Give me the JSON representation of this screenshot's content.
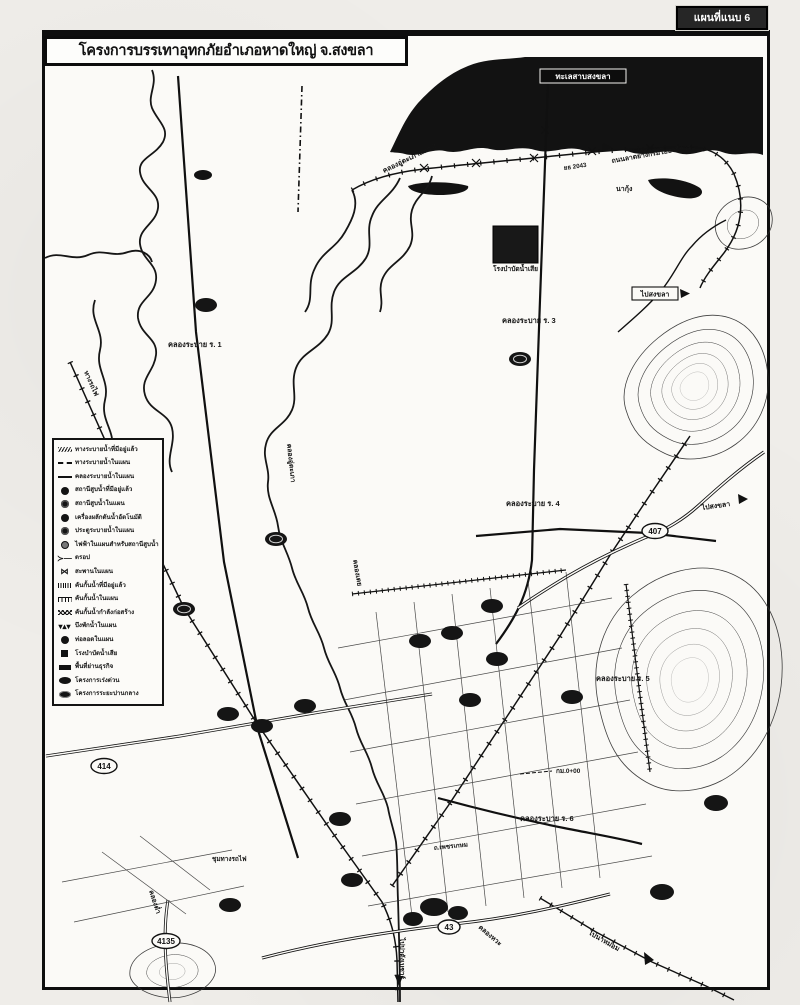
{
  "header": {
    "attachment_tag": "แผนที่แนบ 6",
    "title": "โครงการบรรเทาอุทกภัยอำเภอหาดใหญ่ จ.สงขลา"
  },
  "legend": {
    "items": [
      {
        "icon": "existing-drainage-line-icon",
        "label": "ทางระบายน้ำที่มีอยู่แล้ว"
      },
      {
        "icon": "planned-drainage-line-icon",
        "label": "ทางระบายน้ำในแผน"
      },
      {
        "icon": "planned-canal-line-icon",
        "label": "คลองระบายน้ำในแผน"
      },
      {
        "icon": "existing-pump-station-icon",
        "label": "สถานีสูบน้ำที่มีอยู่แล้ว"
      },
      {
        "icon": "planned-pump-station-icon",
        "label": "สถานีสูบน้ำในแผน"
      },
      {
        "icon": "auto-water-propulsion-icon",
        "label": "เครื่องผลักดันน้ำอัตโนมัติ"
      },
      {
        "icon": "planned-sluice-gate-icon",
        "label": "ประตูระบายน้ำในแผน"
      },
      {
        "icon": "pump-electricity-icon",
        "label": "ไฟฟ้าในแผนสำหรับสถานีสูบน้ำ"
      },
      {
        "icon": "drop-structure-icon",
        "label": "ดรอป"
      },
      {
        "icon": "planned-bridge-icon",
        "label": "สะพานในแผน"
      },
      {
        "icon": "existing-dike-icon",
        "label": "คันกั้นน้ำที่มีอยู่แล้ว"
      },
      {
        "icon": "planned-dike-icon",
        "label": "คันกั้นน้ำในแผน"
      },
      {
        "icon": "dike-under-construction-icon",
        "label": "คันกั้นน้ำกำลังก่อสร้าง"
      },
      {
        "icon": "planned-retention-pond-icon",
        "label": "บึงพักน้ำในแผน"
      },
      {
        "icon": "planned-culvert-icon",
        "label": "ท่อลอดในแผน"
      },
      {
        "icon": "wastewater-plant-icon",
        "label": "โรงบำบัดน้ำเสีย"
      },
      {
        "icon": "business-district-icon",
        "label": "พื้นที่ย่านธุรกิจ"
      },
      {
        "icon": "urgent-project-icon",
        "label": "โครงการเร่งด่วน"
      },
      {
        "icon": "midterm-project-icon",
        "label": "โครงการระยะปานกลาง"
      }
    ]
  },
  "map": {
    "labels": {
      "sea": "ทะเลสาบสงขลา",
      "u_taphao_yaek2": "คลองอู่ตะเภาแยก 2",
      "yotha_road": "ถนนลาดยางกรมโยธาธิการ",
      "road_no_2043": "ยธ 2043",
      "na_kung": "นากุ้ง",
      "wastewater_plant": "โรงบำบัดน้ำเสีย",
      "to_songkhla_upper": "ไปสงขลา",
      "canal_r1": "คลองระบาย ร. 1",
      "canal_r3": "คลองระบาย ร. 3",
      "canal_r4": "คลองระบาย ร. 4",
      "canal_r5": "คลองระบาย ร. 5",
      "canal_r6": "คลองระบาย ร. 6",
      "to_songkhla_right": "ไปสงขลา",
      "km_zero": "กม.0+00",
      "to_na_mom": "ไปนาหม่อม",
      "khlong_wa": "คลองหวะ",
      "to_padang": "ไปปาดังเบซาร์",
      "khlong_tam": "คลองต่ำ",
      "railway": "ทางรถไฟ",
      "khlong_u_taphao": "คลองอู่ตะเภา",
      "khlong_toei": "คลองเตย",
      "rail_junction": "ชุมทางรถไฟ",
      "phetkasem_rd": "ถ.เพชรเกษม"
    },
    "route_badges": {
      "r407": "407",
      "r414": "414",
      "r43": "43",
      "r4135": "4135"
    },
    "colors": {
      "ink": "#111111",
      "paper": "#fbfaf7"
    }
  }
}
